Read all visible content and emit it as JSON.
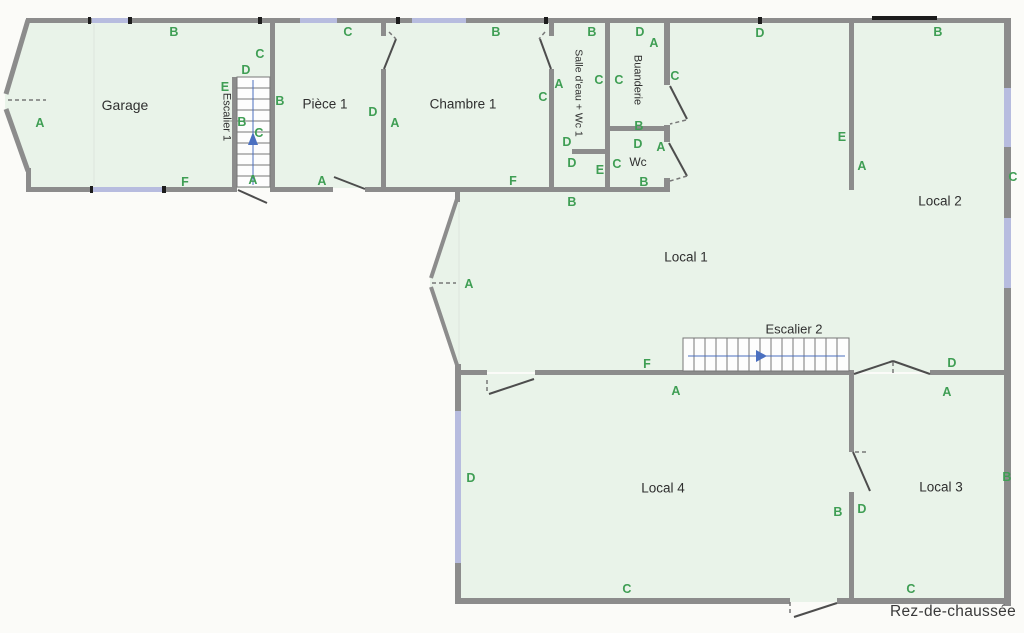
{
  "floor_plan": {
    "title": "Rez-de-chaussée",
    "colors": {
      "room_fill": "#e9f3e9",
      "wall": "#8c8c8c",
      "window": "#b7bcdf",
      "label_green": "#3f9e54",
      "room_text": "#2f2f2f",
      "arrow_blue": "#4a6fc0"
    },
    "rooms": [
      {
        "name": "Garage",
        "x": 125,
        "y": 105,
        "o": "h",
        "fs": 14
      },
      {
        "name": "Escalier 1",
        "x": 226,
        "y": 117,
        "o": "v",
        "fs": 11
      },
      {
        "name": "Pièce 1",
        "x": 325,
        "y": 104,
        "o": "h",
        "fs": 13.5
      },
      {
        "name": "Chambre 1",
        "x": 463,
        "y": 104,
        "o": "h",
        "fs": 13.5
      },
      {
        "name": "Salle d'eau + Wc 1",
        "x": 578,
        "y": 93,
        "o": "v",
        "fs": 10.5
      },
      {
        "name": "Buanderie",
        "x": 637,
        "y": 80,
        "o": "v",
        "fs": 11
      },
      {
        "name": "Wc",
        "x": 638,
        "y": 162,
        "o": "h",
        "fs": 12
      },
      {
        "name": "Local 1",
        "x": 686,
        "y": 257,
        "o": "h",
        "fs": 13.5
      },
      {
        "name": "Local 2",
        "x": 940,
        "y": 201,
        "o": "h",
        "fs": 13.5
      },
      {
        "name": "Escalier 2",
        "x": 794,
        "y": 329,
        "o": "h",
        "fs": 13
      },
      {
        "name": "Local 4",
        "x": 663,
        "y": 488,
        "o": "h",
        "fs": 13.5
      },
      {
        "name": "Local 3",
        "x": 941,
        "y": 487,
        "o": "h",
        "fs": 13.5
      }
    ],
    "wall_labels": [
      {
        "t": "B",
        "x": 174,
        "y": 32
      },
      {
        "t": "A",
        "x": 40,
        "y": 123
      },
      {
        "t": "F",
        "x": 185,
        "y": 182
      },
      {
        "t": "C",
        "x": 260,
        "y": 54
      },
      {
        "t": "D",
        "x": 246,
        "y": 70
      },
      {
        "t": "E",
        "x": 225,
        "y": 87
      },
      {
        "t": "B",
        "x": 242,
        "y": 122
      },
      {
        "t": "C",
        "x": 259,
        "y": 133
      },
      {
        "t": "A",
        "x": 253,
        "y": 180
      },
      {
        "t": "B",
        "x": 280,
        "y": 101
      },
      {
        "t": "C",
        "x": 348,
        "y": 32
      },
      {
        "t": "D",
        "x": 373,
        "y": 112
      },
      {
        "t": "A",
        "x": 322,
        "y": 181
      },
      {
        "t": "B",
        "x": 496,
        "y": 32
      },
      {
        "t": "A",
        "x": 395,
        "y": 123
      },
      {
        "t": "C",
        "x": 543,
        "y": 97
      },
      {
        "t": "F",
        "x": 513,
        "y": 181
      },
      {
        "t": "B",
        "x": 592,
        "y": 32
      },
      {
        "t": "A",
        "x": 559,
        "y": 84
      },
      {
        "t": "C",
        "x": 599,
        "y": 80
      },
      {
        "t": "D",
        "x": 567,
        "y": 142
      },
      {
        "t": "D",
        "x": 572,
        "y": 163
      },
      {
        "t": "E",
        "x": 600,
        "y": 170
      },
      {
        "t": "D",
        "x": 640,
        "y": 32
      },
      {
        "t": "A",
        "x": 654,
        "y": 43
      },
      {
        "t": "C",
        "x": 619,
        "y": 80
      },
      {
        "t": "B",
        "x": 639,
        "y": 126
      },
      {
        "t": "C",
        "x": 675,
        "y": 76
      },
      {
        "t": "D",
        "x": 638,
        "y": 144
      },
      {
        "t": "A",
        "x": 661,
        "y": 147
      },
      {
        "t": "C",
        "x": 617,
        "y": 164
      },
      {
        "t": "B",
        "x": 644,
        "y": 182
      },
      {
        "t": "D",
        "x": 760,
        "y": 33
      },
      {
        "t": "B",
        "x": 938,
        "y": 32
      },
      {
        "t": "E",
        "x": 842,
        "y": 137
      },
      {
        "t": "A",
        "x": 862,
        "y": 166
      },
      {
        "t": "C",
        "x": 1013,
        "y": 177
      },
      {
        "t": "B",
        "x": 572,
        "y": 202
      },
      {
        "t": "A",
        "x": 469,
        "y": 284
      },
      {
        "t": "F",
        "x": 647,
        "y": 364
      },
      {
        "t": "A",
        "x": 676,
        "y": 391
      },
      {
        "t": "D",
        "x": 952,
        "y": 363
      },
      {
        "t": "A",
        "x": 947,
        "y": 392
      },
      {
        "t": "B",
        "x": 1007,
        "y": 477
      },
      {
        "t": "B",
        "x": 838,
        "y": 512
      },
      {
        "t": "D",
        "x": 862,
        "y": 509
      },
      {
        "t": "C",
        "x": 911,
        "y": 589
      },
      {
        "t": "D",
        "x": 471,
        "y": 478
      },
      {
        "t": "C",
        "x": 627,
        "y": 589
      }
    ]
  }
}
